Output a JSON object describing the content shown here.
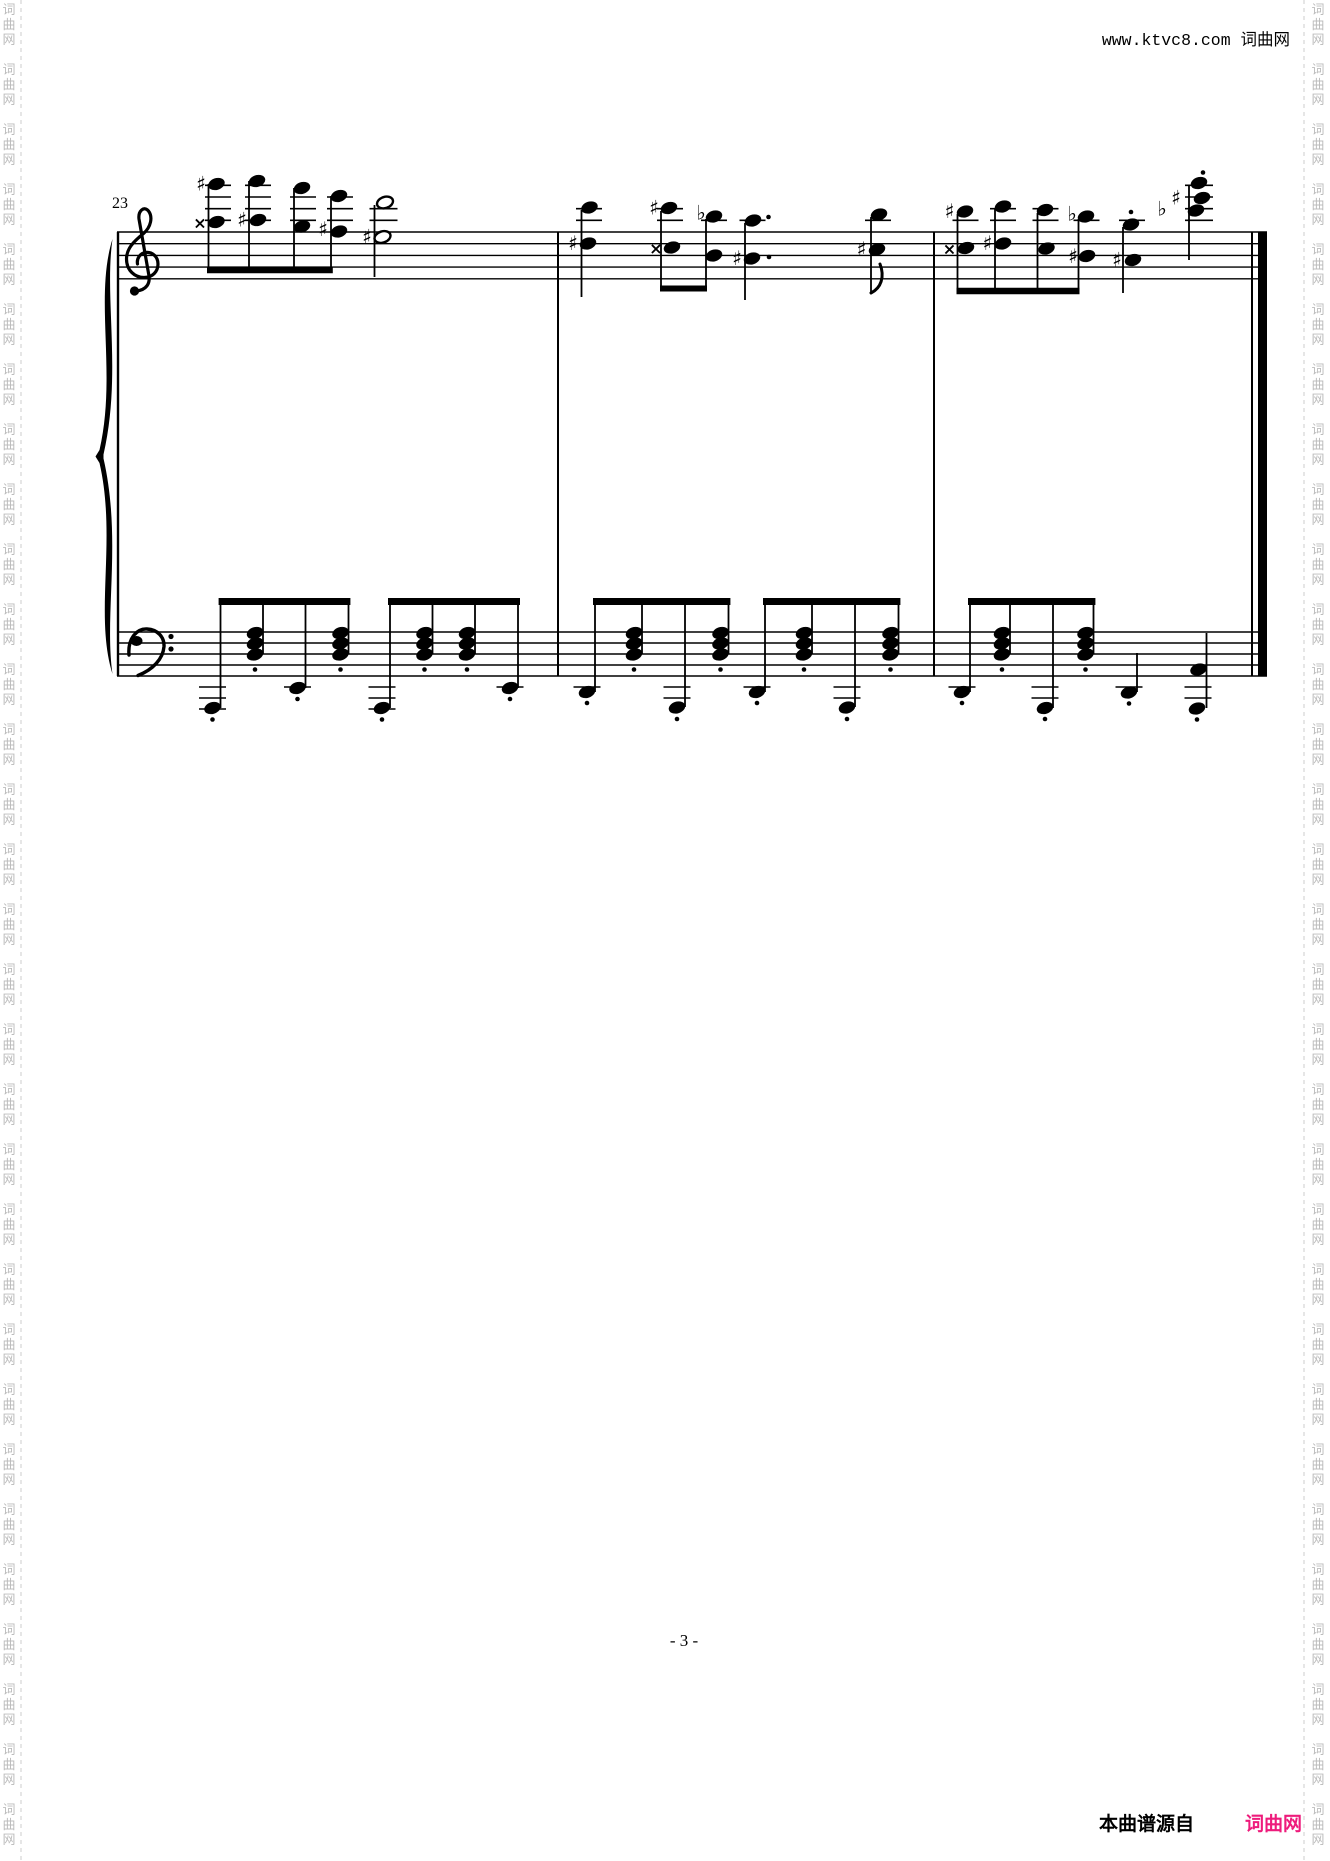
{
  "header": {
    "site_text": "www.ktvc8.com 词曲网"
  },
  "footer": {
    "page_number": "- 3 -",
    "source_label": "本曲谱源自",
    "site_name": "词曲网",
    "site_color": "#ee1c7c"
  },
  "watermark": {
    "chars": [
      "词",
      "曲",
      "网"
    ],
    "color": "#bcbcbc",
    "line_color": "#cccccc",
    "left_char_x": 9,
    "right_char_x": 1318,
    "left_line_x": 21,
    "right_line_x": 1304,
    "start_y": 14,
    "char_pitch": 15,
    "group_period": 60,
    "groups": 31,
    "font_size": 13
  },
  "score": {
    "measure_number": "23",
    "ink_color": "#000000",
    "geometry": {
      "x_start": 117,
      "x_end": 1267,
      "treble_top": 232,
      "treble_gap": 11.7,
      "bass_top": 632,
      "bass_gap": 11,
      "barlines": [
        558,
        934
      ],
      "final_thin_x": 1252,
      "final_thick_x": 1262.5,
      "final_thick_w": 9,
      "staff_line_w": 1.4
    },
    "beams": [
      [
        208,
        331.8,
        270,
        6.5
      ],
      [
        661,
        706,
        288.5,
        6
      ],
      [
        957.5,
        1078.5,
        291,
        6.5
      ],
      [
        219.6,
        349.4,
        601.5,
        7
      ],
      [
        389,
        519,
        601.5,
        7
      ],
      [
        594,
        729.4,
        601.5,
        7
      ],
      [
        764,
        899.4,
        601.5,
        7
      ],
      [
        969,
        1094.4,
        601.5,
        7
      ]
    ],
    "stems": [
      [
        208.5,
        184,
        270
      ],
      [
        249,
        181,
        270
      ],
      [
        294,
        188,
        270
      ],
      [
        331,
        196,
        270
      ],
      [
        374.5,
        205,
        277
      ],
      [
        581.5,
        210,
        297
      ],
      [
        661,
        211,
        288.5
      ],
      [
        706,
        219,
        288.5
      ],
      [
        745,
        223,
        300
      ],
      [
        871,
        217,
        293
      ],
      [
        957.5,
        214,
        291
      ],
      [
        995,
        209,
        291
      ],
      [
        1037.5,
        213,
        291
      ],
      [
        1078.5,
        219,
        291
      ],
      [
        1123,
        227,
        293
      ],
      [
        1189,
        186,
        260
      ],
      [
        220.5,
        601.5,
        708
      ],
      [
        263,
        601.5,
        654
      ],
      [
        305.5,
        601.5,
        688
      ],
      [
        348.5,
        601.5,
        654
      ],
      [
        390,
        601.5,
        708
      ],
      [
        432.5,
        601.5,
        654
      ],
      [
        475,
        601.5,
        654
      ],
      [
        518,
        601.5,
        688
      ],
      [
        595,
        601.5,
        692
      ],
      [
        642,
        601.5,
        654
      ],
      [
        685,
        601.5,
        707
      ],
      [
        728.5,
        601.5,
        654
      ],
      [
        765,
        601.5,
        692
      ],
      [
        812,
        601.5,
        654
      ],
      [
        855,
        601.5,
        707
      ],
      [
        898.5,
        601.5,
        654
      ],
      [
        970,
        601.5,
        692
      ],
      [
        1010,
        601.5,
        654
      ],
      [
        1053,
        601.5,
        708
      ],
      [
        1093.5,
        601.5,
        654
      ],
      [
        1137,
        653,
        692
      ],
      [
        1206.5,
        633,
        708
      ]
    ],
    "noteheads_filled": [
      [
        216.5,
        184
      ],
      [
        216.5,
        222
      ],
      [
        257,
        181
      ],
      [
        258,
        220
      ],
      [
        302,
        188
      ],
      [
        302,
        226.5
      ],
      [
        339,
        196
      ],
      [
        339,
        231.5
      ],
      [
        589.5,
        207.5
      ],
      [
        588,
        243.5
      ],
      [
        669,
        208
      ],
      [
        672,
        247.5
      ],
      [
        714,
        216.5
      ],
      [
        714,
        255.5
      ],
      [
        753,
        220.5
      ],
      [
        752,
        258.5
      ],
      [
        879,
        214.5
      ],
      [
        877,
        249.5
      ],
      [
        965,
        211.5
      ],
      [
        966,
        248
      ],
      [
        1003,
        206.5
      ],
      [
        1003,
        243.5
      ],
      [
        1045,
        210
      ],
      [
        1046.5,
        248.5
      ],
      [
        1086,
        216.5
      ],
      [
        1087,
        256
      ],
      [
        1131,
        224.5
      ],
      [
        1133,
        260
      ],
      [
        1199,
        183
      ],
      [
        1202,
        198
      ],
      [
        1196,
        210.5
      ],
      [
        212.5,
        708
      ],
      [
        297.5,
        688
      ],
      [
        382,
        708
      ],
      [
        510,
        688
      ],
      [
        587,
        692
      ],
      [
        677,
        707.5
      ],
      [
        757,
        692
      ],
      [
        847,
        707.5
      ],
      [
        962,
        692
      ],
      [
        1045,
        708
      ],
      [
        1129,
        692.5
      ],
      [
        1198.5,
        669.5
      ],
      [
        1197,
        708.5
      ]
    ],
    "noteheads_open": [
      [
        385,
        202.5
      ],
      [
        382.5,
        237
      ]
    ],
    "bass_chords": {
      "xs": [
        255,
        340.5,
        424.5,
        467,
        634,
        720.5,
        804,
        890.5,
        1002,
        1085.5
      ],
      "ys": [
        633,
        643.5,
        654.5
      ],
      "staccato_y": 669.5
    },
    "accidentals": [
      {
        "g": "s",
        "x": 201,
        "y": 184
      },
      {
        "g": "x",
        "x": 200,
        "y": 222
      },
      {
        "g": "s",
        "x": 242,
        "y": 220
      },
      {
        "g": "s",
        "x": 323,
        "y": 229.5
      },
      {
        "g": "s",
        "x": 367,
        "y": 237
      },
      {
        "g": "s",
        "x": 573,
        "y": 243.5
      },
      {
        "g": "s",
        "x": 654,
        "y": 208
      },
      {
        "g": "x",
        "x": 656,
        "y": 247.5
      },
      {
        "g": "f",
        "x": 701,
        "y": 213
      },
      {
        "g": "s",
        "x": 737,
        "y": 258.5
      },
      {
        "g": "s",
        "x": 861.5,
        "y": 249.5
      },
      {
        "g": "s",
        "x": 949.5,
        "y": 211.5
      },
      {
        "g": "x",
        "x": 949.5,
        "y": 248
      },
      {
        "g": "s",
        "x": 987.5,
        "y": 243.5
      },
      {
        "g": "f",
        "x": 1072,
        "y": 214
      },
      {
        "g": "s",
        "x": 1073,
        "y": 256.5
      },
      {
        "g": "s",
        "x": 1117,
        "y": 260
      },
      {
        "g": "f",
        "x": 1162,
        "y": 209
      },
      {
        "g": "s",
        "x": 1176,
        "y": 198
      }
    ],
    "ledgers": [
      {
        "x": 218,
        "w": 26,
        "ys": [
          220.3,
          208.7,
          197,
          185.3
        ]
      },
      {
        "x": 258,
        "w": 26,
        "ys": [
          220.3,
          208.7,
          197,
          185.3
        ]
      },
      {
        "x": 303,
        "w": 26,
        "ys": [
          220.3,
          208.7,
          197
        ]
      },
      {
        "x": 340,
        "w": 26,
        "ys": [
          220.3,
          208.7,
          197
        ]
      },
      {
        "x": 383.5,
        "w": 28,
        "ys": [
          220.3,
          208.7
        ]
      },
      {
        "x": 589,
        "w": 26,
        "ys": [
          220.3,
          208.7
        ]
      },
      {
        "x": 670,
        "w": 26,
        "ys": [
          220.3,
          208.7
        ]
      },
      {
        "x": 714,
        "w": 26,
        "ys": [
          220.3
        ]
      },
      {
        "x": 752.5,
        "w": 26,
        "ys": [
          220.3
        ]
      },
      {
        "x": 878,
        "w": 26,
        "ys": [
          220.3
        ]
      },
      {
        "x": 965.5,
        "w": 26,
        "ys": [
          220.3
        ]
      },
      {
        "x": 1003,
        "w": 26,
        "ys": [
          220.3,
          208.7
        ]
      },
      {
        "x": 1045.5,
        "w": 26,
        "ys": [
          220.3,
          208.7
        ]
      },
      {
        "x": 1086.5,
        "w": 26,
        "ys": [
          220.3
        ]
      },
      {
        "x": 1132,
        "w": 26,
        "ys": [
          220.3
        ]
      },
      {
        "x": 1199,
        "w": 28,
        "ys": [
          220.3,
          208.7,
          197,
          185.3
        ]
      },
      {
        "x": 212.5,
        "w": 27,
        "ys": [
          687,
          698,
          709
        ]
      },
      {
        "x": 297.5,
        "w": 27,
        "ys": [
          687
        ]
      },
      {
        "x": 382,
        "w": 27,
        "ys": [
          687,
          698,
          709
        ]
      },
      {
        "x": 510,
        "w": 27,
        "ys": [
          687
        ]
      },
      {
        "x": 587,
        "w": 27,
        "ys": [
          687
        ]
      },
      {
        "x": 677,
        "w": 27,
        "ys": [
          687,
          698
        ]
      },
      {
        "x": 757,
        "w": 27,
        "ys": [
          687
        ]
      },
      {
        "x": 847,
        "w": 27,
        "ys": [
          687,
          698
        ]
      },
      {
        "x": 962,
        "w": 27,
        "ys": [
          687
        ]
      },
      {
        "x": 1045,
        "w": 27,
        "ys": [
          687,
          698
        ]
      },
      {
        "x": 1129,
        "w": 27,
        "ys": [
          687
        ]
      },
      {
        "x": 1198,
        "w": 27,
        "ys": [
          687,
          698
        ]
      }
    ],
    "dots": [
      [
        768.5,
        217
      ],
      [
        769,
        257
      ],
      [
        1131,
        212
      ],
      [
        1203,
        172.5
      ],
      [
        212.5,
        719.5
      ],
      [
        297.5,
        699
      ],
      [
        382,
        719.5
      ],
      [
        510,
        699
      ],
      [
        587,
        703
      ],
      [
        677,
        719
      ],
      [
        757,
        703
      ],
      [
        847,
        719
      ],
      [
        962,
        703
      ],
      [
        1045,
        719
      ],
      [
        1129,
        703.5
      ],
      [
        1197,
        719.5
      ]
    ],
    "flags": [
      [
        871,
        293
      ]
    ]
  }
}
